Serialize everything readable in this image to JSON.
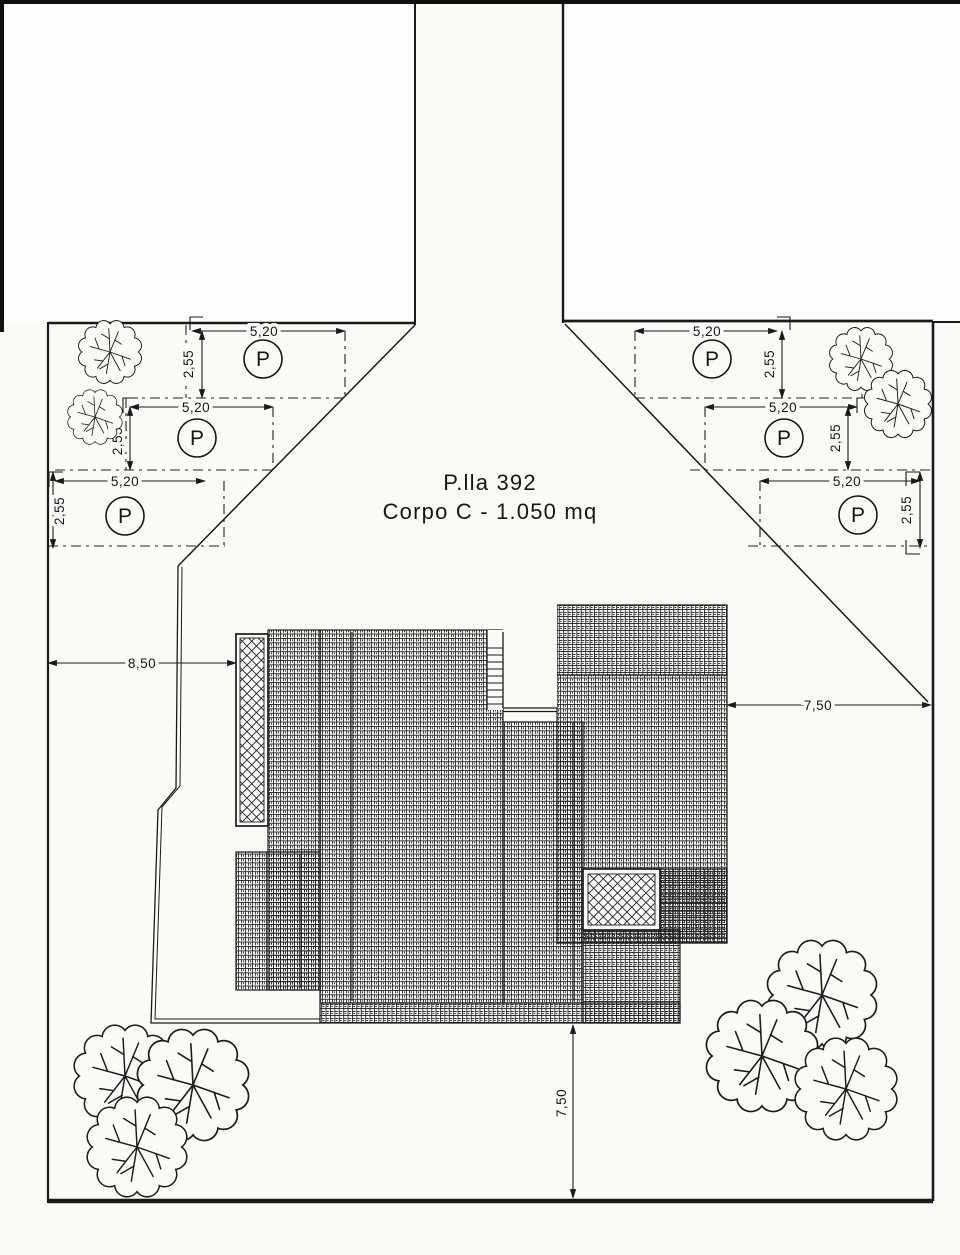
{
  "plan": {
    "parcel_title": "P.lla 392",
    "parcel_subtitle": "Corpo C - 1.050 mq"
  },
  "labels": {
    "parking_symbol": "P",
    "stall_width": "5,20",
    "stall_depth": "2,55",
    "setback_left": "8,50",
    "setback_right": "7,50",
    "setback_bottom": "7,50"
  }
}
